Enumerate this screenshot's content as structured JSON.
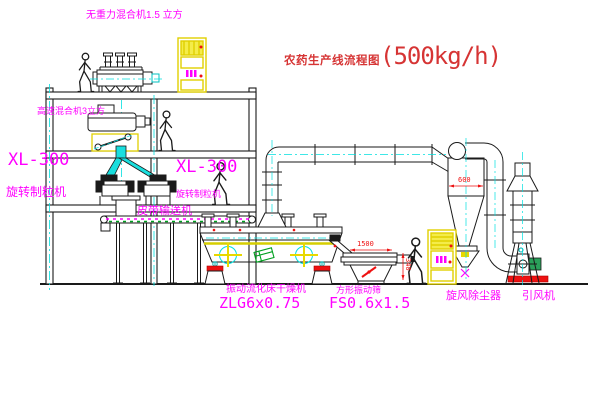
{
  "title": {
    "cn": "农药生产线流程图",
    "capacity": "(500kg/h)"
  },
  "labels": {
    "top_mixer": "无重力混合机1.5 立方",
    "mixer2": "高速混合机3立方",
    "granulator_left_model": "XL-300",
    "granulator_left_name": "旋转制粒机",
    "granulator_mid_model": "XL-300",
    "granulator_mid_name": "旋转制粒机",
    "conveyor": "皮带输送机",
    "dryer_name": "振动流化床干燥机",
    "dryer_model": "ZLG6x0.75",
    "screen_name": "方形振动筛",
    "screen_model": "FS0.6x1.5",
    "cyclone": "旋风除尘器",
    "fan": "引风机"
  },
  "dimensions": {
    "cyclone_diameter": "600",
    "screen_length": "1500",
    "screen_height": "340"
  },
  "colors": {
    "label_magenta": "#ff00ff",
    "title_red": "#d63434",
    "dimension_red": "#ee1111",
    "centerline_cyan": "#00e0e0",
    "cabinet_yellow": "#e8d800",
    "line_black": "#1a1a1a"
  }
}
